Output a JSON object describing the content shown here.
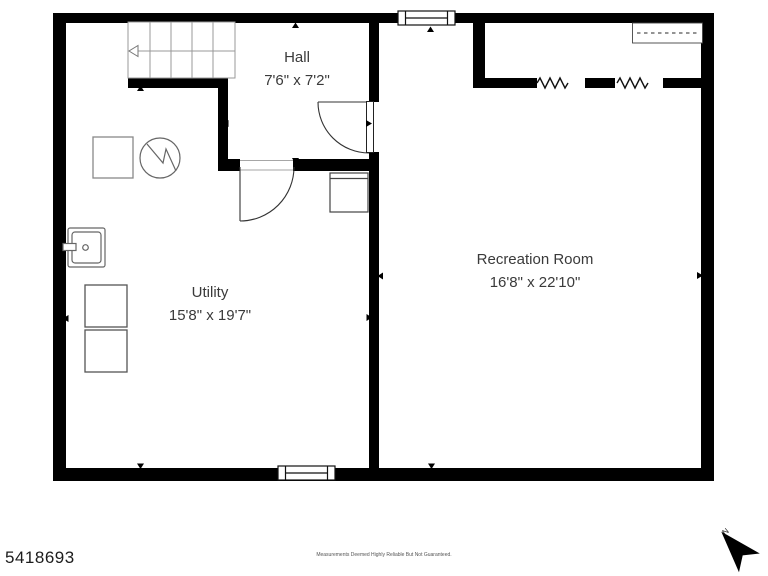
{
  "plan": {
    "rooms": [
      {
        "name": "Hall",
        "dims": "7'6\" x 7'2\""
      },
      {
        "name": "Utility",
        "dims": "15'8\" x 19'7\""
      },
      {
        "name": "Recreation Room",
        "dims": "16'8\" x 22'10\""
      }
    ],
    "fixtures": [
      "stairs-icon",
      "water-heater-icon",
      "sink-icon",
      "washer-icon",
      "dryer-icon",
      "appliance-icon",
      "closet-shelf-icon",
      "window-icon",
      "door-swing-icon"
    ],
    "footer": {
      "listing_id": "5418693",
      "disclaimer": "Measurements Deemed Highly Reliable But Not Guaranteed.",
      "north_label": "N"
    },
    "colors": {
      "wall": "#000000",
      "fixture_line": "#666666",
      "label_text": "#3a3a3a"
    }
  }
}
